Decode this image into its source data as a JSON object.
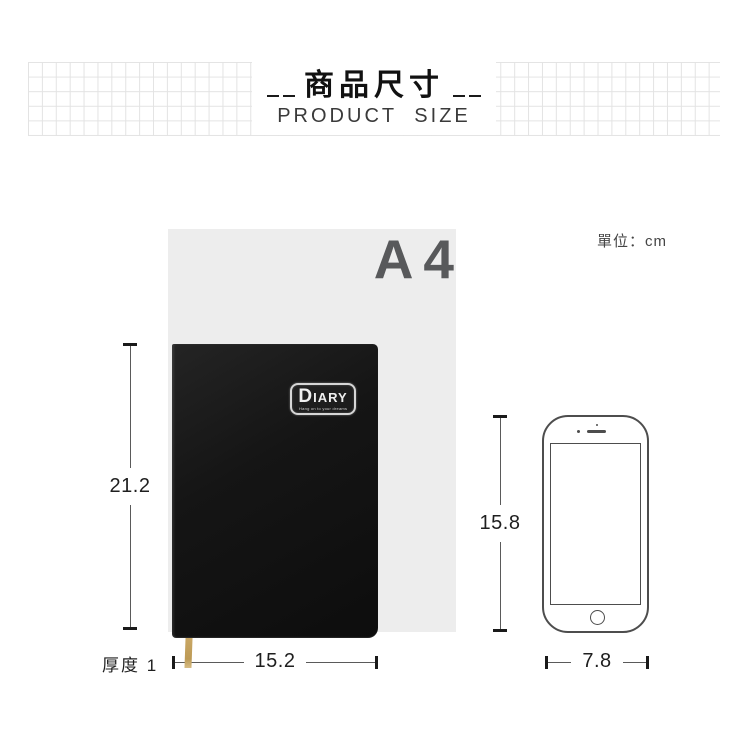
{
  "header": {
    "title": "商品尺寸",
    "subtitle": "PRODUCT SIZE"
  },
  "comparison": {
    "paper_label": "A4",
    "unit_label": "單位：cm"
  },
  "diary": {
    "logo_d": "D",
    "logo_rest": "IARY",
    "tagline": "Hang on to your dreams"
  },
  "dimensions": {
    "diary_height": "21.2",
    "diary_width": "15.2",
    "thickness_label": "厚度 1",
    "phone_height": "15.8",
    "phone_width": "7.8"
  },
  "colors": {
    "paper": "#ededed",
    "diary_cover": "#141414",
    "ribbon": "#c9a765",
    "dimension_line": "#5a5a5a",
    "dimension_cap": "#1a1a1a",
    "text_dark": "#1f1f1f",
    "a4_label": "#58595b",
    "grid_line": "#e3e3e3",
    "phone_outline": "#4d4d4d"
  }
}
